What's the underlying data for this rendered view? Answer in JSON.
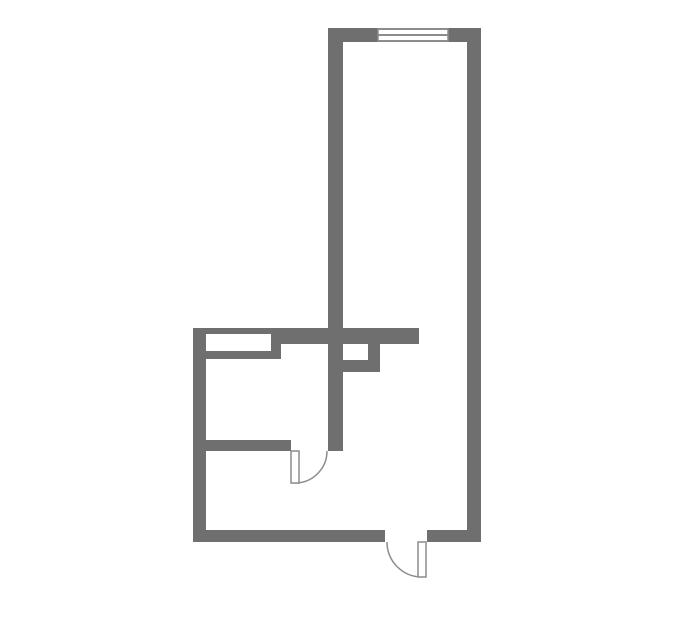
{
  "canvas": {
    "width": 679,
    "height": 634
  },
  "colors": {
    "background": "#ffffff",
    "wall": "#6f6f6f",
    "thin_line": "#8c8c8c",
    "fixture_fill": "#ffffff"
  },
  "floorplan": {
    "walls": [
      {
        "id": "top-wall-left-of-window",
        "x": 328,
        "y": 28,
        "w": 50,
        "h": 14
      },
      {
        "id": "top-wall-right-of-window",
        "x": 448,
        "y": 28,
        "w": 33,
        "h": 14
      },
      {
        "id": "right-outer-wall",
        "x": 467,
        "y": 28,
        "w": 14,
        "h": 514
      },
      {
        "id": "upper-room-left-wall",
        "x": 328,
        "y": 28,
        "w": 15,
        "h": 423
      },
      {
        "id": "mid-horizontal-wall",
        "x": 281,
        "y": 328,
        "w": 138,
        "h": 16
      },
      {
        "id": "niche-top-strip",
        "x": 193,
        "y": 328,
        "w": 88,
        "h": 6
      },
      {
        "id": "niche-bottom-strip",
        "x": 193,
        "y": 351,
        "w": 88,
        "h": 8
      },
      {
        "id": "niche-right-block",
        "x": 271,
        "y": 328,
        "w": 10,
        "h": 31
      },
      {
        "id": "left-outer-wall",
        "x": 193,
        "y": 328,
        "w": 13,
        "h": 214
      },
      {
        "id": "partition-wall",
        "x": 193,
        "y": 440,
        "w": 98,
        "h": 11
      },
      {
        "id": "bottom-wall-left",
        "x": 193,
        "y": 530,
        "w": 192,
        "h": 12
      },
      {
        "id": "bottom-wall-right",
        "x": 427,
        "y": 530,
        "w": 54,
        "h": 12
      },
      {
        "id": "shaft-right-wall",
        "x": 368,
        "y": 344,
        "w": 12,
        "h": 28
      },
      {
        "id": "shaft-bottom-wall",
        "x": 328,
        "y": 360,
        "w": 52,
        "h": 12
      }
    ],
    "windows": [
      {
        "id": "top-window",
        "x": 378,
        "y": 28,
        "w": 70,
        "h": 14
      }
    ],
    "doors": [
      {
        "id": "interior-door",
        "leaf": {
          "x": 291,
          "y": 451,
          "w": 8,
          "h": 32
        },
        "arc": {
          "sx": 295,
          "sy": 483,
          "ex": 327,
          "ey": 451,
          "r": 32,
          "sweep": 0
        }
      },
      {
        "id": "entry-door",
        "leaf": {
          "x": 418,
          "y": 542,
          "w": 8,
          "h": 35
        },
        "arc": {
          "sx": 387,
          "sy": 542,
          "ex": 422,
          "ey": 577,
          "r": 35,
          "sweep": 0
        }
      }
    ]
  }
}
